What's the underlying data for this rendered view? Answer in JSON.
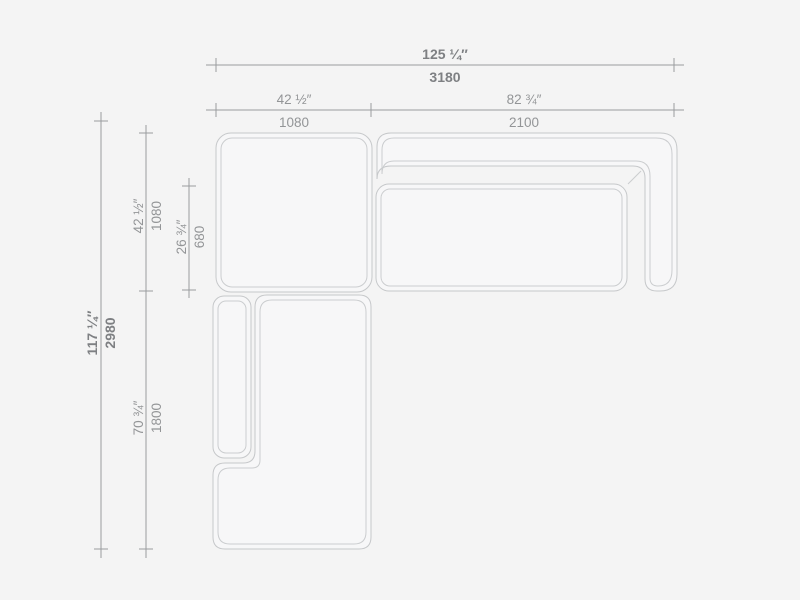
{
  "page": {
    "title": "Sectional sofa plan - dimensioned technical drawing",
    "colors": {
      "background": "#f4f4f4",
      "sofa_outline": "#c6c8ca",
      "dimension_line": "#9a9c9e",
      "label_bold": "#7e8083",
      "label_regular": "#939597"
    }
  },
  "dimensions": {
    "total_width": {
      "inches": "125 ¼″",
      "mm": "3180"
    },
    "corner_width": {
      "inches": "42 ½″",
      "mm": "1080"
    },
    "sofa_width": {
      "inches": "82 ¾″",
      "mm": "2100"
    },
    "total_depth": {
      "inches": "117 ¼″",
      "mm": "2980"
    },
    "corner_depth": {
      "inches": "42 ½″",
      "mm": "1080"
    },
    "seat_depth": {
      "inches": "26 ¾″",
      "mm": "680"
    },
    "chaise_length": {
      "inches": "70 ¾″",
      "mm": "1800"
    }
  }
}
